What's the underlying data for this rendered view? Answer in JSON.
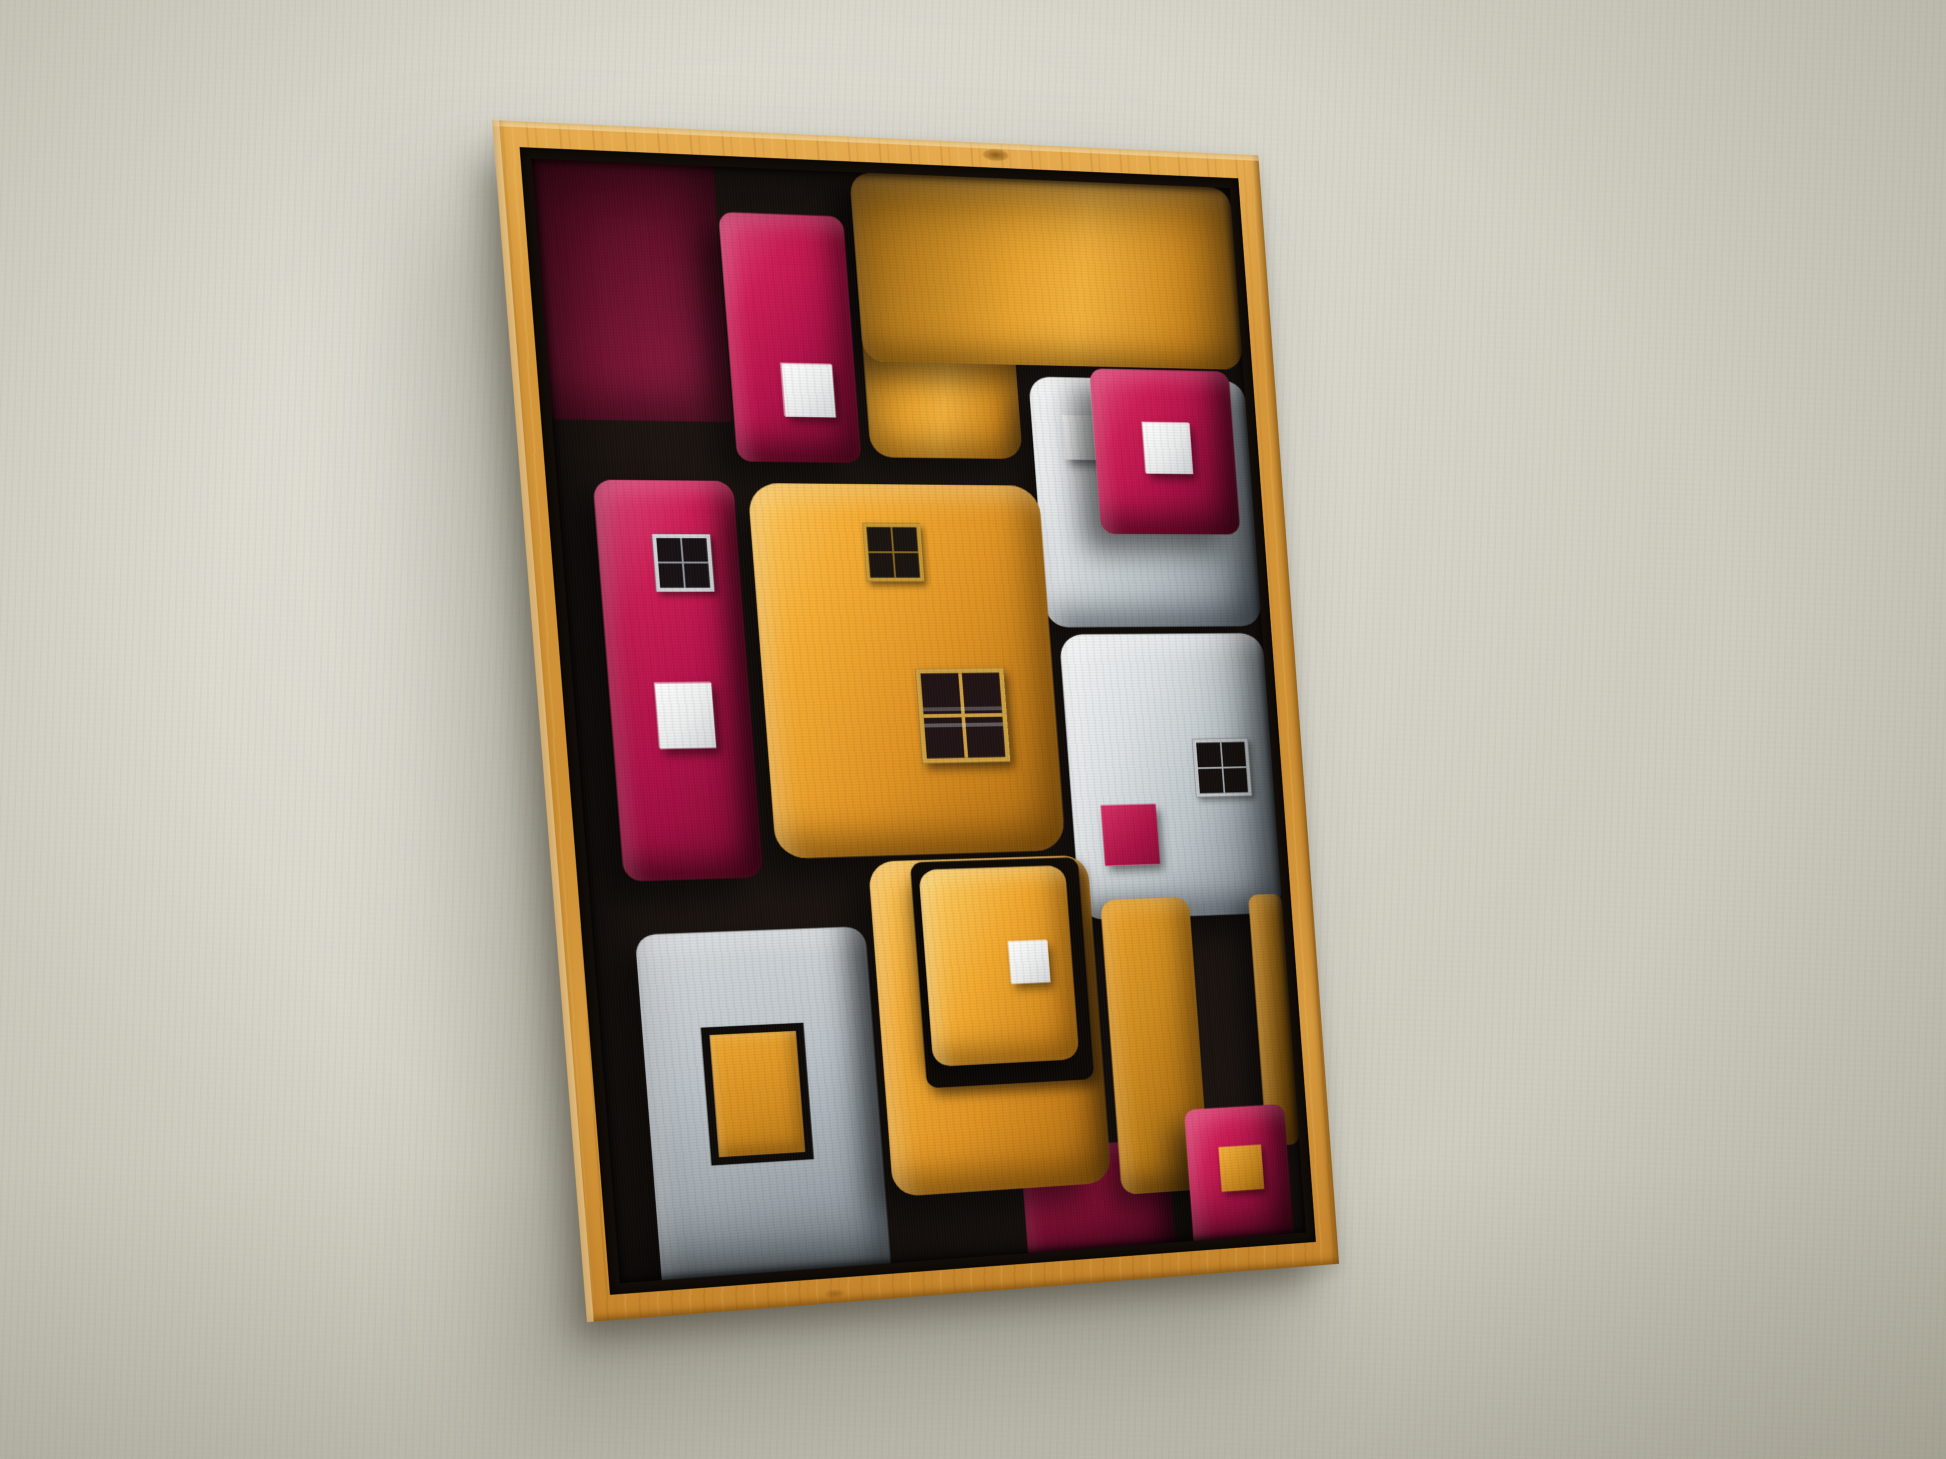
{
  "scene": {
    "description": "Abstract painting of stacked rounded blocks in a natural wood floating frame, hanging on a textured off-white wall, photographed at a slight angle with soft shadow to the lower left",
    "wall": {
      "color": "#d4d2c6"
    },
    "frame": {
      "style": "natural pine floating frame",
      "wood_color": "#d0913a",
      "liner_color": "#140e09"
    },
    "painting": {
      "background": "#1b1410",
      "palette": {
        "magenta": "#c4164e",
        "maroon": "#7c1430",
        "amber": "#e9a22d",
        "gray": "#c3cad0",
        "white": "#ececec",
        "black_outline": "#0e0a07"
      },
      "blocks": [
        {
          "name": "maroon-panel-top-left",
          "kind": "maroon",
          "x": 0,
          "y": 0,
          "w": 172,
          "h": 258,
          "r": 4
        },
        {
          "name": "orange-band-left-extension",
          "kind": "amber-band",
          "x": 306,
          "y": 0,
          "w": 154,
          "h": 292,
          "r": 22
        },
        {
          "name": "orange-top-band",
          "kind": "amber-band",
          "x": 306,
          "y": 0,
          "w": 394,
          "h": 194,
          "r": 22
        },
        {
          "name": "gray-top-right-block",
          "kind": "gray",
          "x": 472,
          "y": 206,
          "w": 228,
          "h": 262,
          "r": 22,
          "children": [
            {
              "name": "white-square",
              "kind": "white-sq",
              "x": 32,
              "y": 40,
              "w": 44,
              "h": 46
            }
          ]
        },
        {
          "name": "magenta-top-right-block",
          "kind": "magenta",
          "x": 536,
          "y": 196,
          "w": 148,
          "h": 174,
          "r": 14,
          "children": [
            {
              "name": "white-square",
              "kind": "white-sq",
              "x": 52,
              "y": 56,
              "w": 50,
              "h": 54
            }
          ]
        },
        {
          "name": "magenta-top-block",
          "kind": "magenta",
          "x": 174,
          "y": 46,
          "w": 122,
          "h": 252,
          "r": 14,
          "children": [
            {
              "name": "white-square",
              "kind": "white-sq",
              "x": 50,
              "y": 152,
              "w": 50,
              "h": 54
            }
          ]
        },
        {
          "name": "magenta-tall-left-block",
          "kind": "magenta",
          "x": 34,
          "y": 318,
          "w": 134,
          "h": 402,
          "r": 18,
          "children": [
            {
              "name": "dark-window",
              "kind": "window-silver",
              "x": 52,
              "y": 54,
              "w": 56,
              "h": 58
            },
            {
              "name": "white-square",
              "kind": "white-sq",
              "x": 44,
              "y": 204,
              "w": 54,
              "h": 66
            }
          ]
        },
        {
          "name": "gray-right-lower-block",
          "kind": "gray",
          "x": 484,
          "y": 476,
          "w": 216,
          "h": 300,
          "r": 24,
          "children": [
            {
              "name": "dark-window",
              "kind": "window-gray",
              "x": 132,
              "y": 112,
              "w": 60,
              "h": 62
            },
            {
              "name": "magenta-square",
              "kind": "magenta-sq",
              "x": 30,
              "y": 180,
              "w": 58,
              "h": 64
            }
          ]
        },
        {
          "name": "yellow-central-block",
          "kind": "amber",
          "x": 182,
          "y": 320,
          "w": 292,
          "h": 382,
          "r": 30,
          "children": [
            {
              "name": "small-window",
              "kind": "window-amber",
              "x": 110,
              "y": 40,
              "w": 58,
              "h": 60
            },
            {
              "name": "large-window",
              "kind": "window-amber-large",
              "x": 152,
              "y": 190,
              "w": 90,
              "h": 98
            }
          ]
        },
        {
          "name": "gray-bottom-left-block",
          "kind": "gray2",
          "x": 40,
          "y": 774,
          "w": 224,
          "h": 366,
          "r": 20,
          "children": [
            {
              "name": "yellow-framed-square",
              "kind": "yellow-framed-sq",
              "x": 56,
              "y": 96,
              "w": 100,
              "h": 140
            }
          ]
        },
        {
          "name": "magenta-bottom-center-block",
          "kind": "magenta-dark",
          "x": 404,
          "y": 1012,
          "w": 154,
          "h": 128,
          "r": 10
        },
        {
          "name": "big-yellow-bottom-block",
          "kind": "amber",
          "x": 272,
          "y": 708,
          "w": 224,
          "h": 346,
          "r": 26,
          "children": [
            {
              "name": "black-inset-outline",
              "kind": "black-inset",
              "x": 42,
              "y": 2,
              "w": 172,
              "h": 234,
              "r": 12,
              "children": [
                {
                  "name": "small-yellow-inner-block",
                  "kind": "amber-bright",
                  "x": 8,
                  "y": 8,
                  "w": 150,
                  "h": 204,
                  "r": 18,
                  "children": [
                    {
                      "name": "white-square",
                      "kind": "white-sq",
                      "x": 86,
                      "y": 78,
                      "w": 40,
                      "h": 44
                    }
                  ]
                }
              ]
            }
          ]
        },
        {
          "name": "mid-yellow-right-block",
          "kind": "amber-dark",
          "x": 506,
          "y": 756,
          "w": 94,
          "h": 312,
          "r": 16
        },
        {
          "name": "right-yellow-column",
          "kind": "amber-dark",
          "x": 664,
          "y": 756,
          "w": 36,
          "h": 270,
          "r": 10
        },
        {
          "name": "magenta-bottom-right-block",
          "kind": "magenta",
          "x": 578,
          "y": 982,
          "w": 108,
          "h": 158,
          "r": 12,
          "children": [
            {
              "name": "yellow-square",
              "kind": "yellow-sq",
              "x": 34,
              "y": 42,
              "w": 46,
              "h": 48
            }
          ]
        }
      ]
    }
  }
}
